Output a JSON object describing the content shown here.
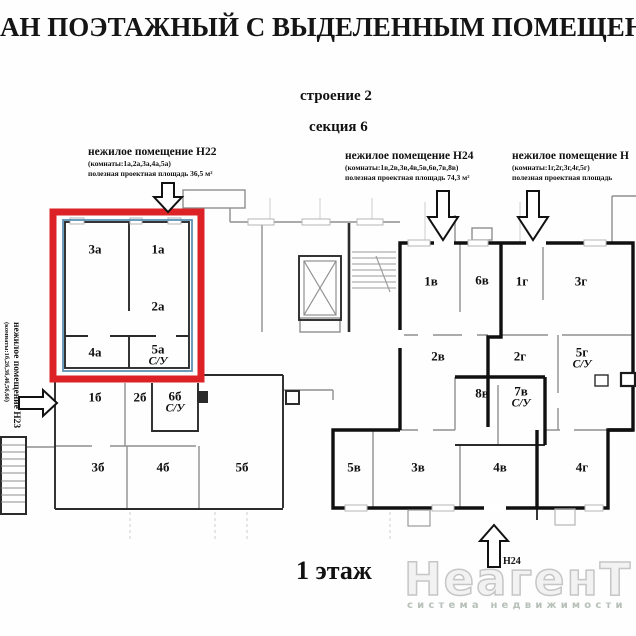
{
  "page": {
    "title": "АН ПОЭТАЖНЫЙ С ВЫДЕЛЕННЫМ ПОМЕЩЕНИЕ",
    "building": "строение 2",
    "section": "секция 6",
    "floor": "1 этаж"
  },
  "premises": [
    {
      "name": "нежилое помещение Н22",
      "rooms_note": "(комнаты:1а,2а,3а,4а,5а)",
      "area_note": "полезная проектная площадь 36,5 м²"
    },
    {
      "name": "нежилое помещение Н24",
      "rooms_note": "(комнаты:1в,2в,3в,4в,5в,6в,7в,8в)",
      "area_note": "полезная проектная площадь 74,3 м²"
    },
    {
      "name": "нежилое помещение Н",
      "rooms_note": "(комнаты:1г,2г,3г,4г,5г)",
      "area_note": "полезная проектная площадь"
    },
    {
      "name": "нежилое помещение Н23",
      "rooms_note": "(комнаты:1б,2б,3б,4б,5б,6б)"
    }
  ],
  "rooms": [
    {
      "label": "3а"
    },
    {
      "label": "1а"
    },
    {
      "label": "2а"
    },
    {
      "label": "4а"
    },
    {
      "label": "5а",
      "sub": "С/У"
    },
    {
      "label": "1б"
    },
    {
      "label": "2б"
    },
    {
      "label": "6б",
      "sub": "С/У"
    },
    {
      "label": "3б"
    },
    {
      "label": "4б"
    },
    {
      "label": "5б"
    },
    {
      "label": "1в"
    },
    {
      "label": "6в"
    },
    {
      "label": "2в"
    },
    {
      "label": "8в"
    },
    {
      "label": "7в",
      "sub": "С/У"
    },
    {
      "label": "5в"
    },
    {
      "label": "3в"
    },
    {
      "label": "4в"
    },
    {
      "label": "1г"
    },
    {
      "label": "3г"
    },
    {
      "label": "2г"
    },
    {
      "label": "5г",
      "sub": "С/У"
    },
    {
      "label": "4г"
    }
  ],
  "annotations": {
    "entrance_h24": "Н24"
  },
  "watermark": {
    "brand": "НеагенТ",
    "tagline": "система недвижимости"
  },
  "colors": {
    "highlight_red": "#dc2127",
    "highlight_blue": "#5d91b5",
    "wall_bold": "#101010",
    "wall_gray": "#8f8f8f"
  }
}
